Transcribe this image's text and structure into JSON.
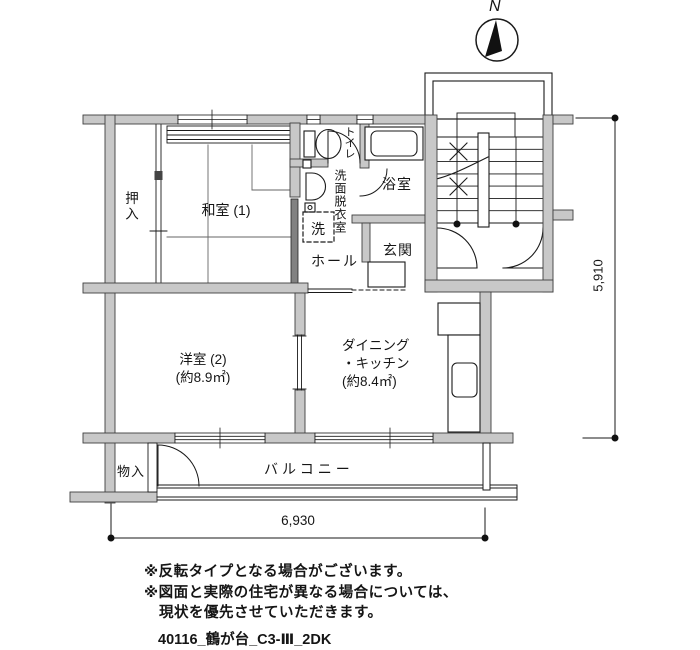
{
  "north": {
    "label": "N"
  },
  "rooms": {
    "oshiire": "押入",
    "washitsu": "和室 (1)",
    "toilet": "トイレ",
    "senmen_datsuiishitsu": "洗面脱衣室",
    "laundry": "洗",
    "bathroom": "浴室",
    "hall": "ホール",
    "genkan": "玄関",
    "yoshitsu_name": "洋室 (2)",
    "yoshitsu_area": "(約8.9㎡)",
    "dk_name1": "ダイニング",
    "dk_name2": "・キッチン",
    "dk_area": "(約8.4㎡)",
    "monoire": "物入",
    "balcony": "バルコニー"
  },
  "dimensions": {
    "height_mm": "5,910",
    "width_mm": "6,930"
  },
  "notes": {
    "line1": "※反転タイプとなる場合がございます。",
    "line2": "※図面と実際の住宅が異なる場合については、",
    "line3": "現状を優先させていただきます。"
  },
  "plan_id": "40116_鶴が台_C3-Ⅲ_2DK",
  "colors": {
    "wall_fill": "#c8c8c8",
    "line": "#1a1a1a"
  }
}
